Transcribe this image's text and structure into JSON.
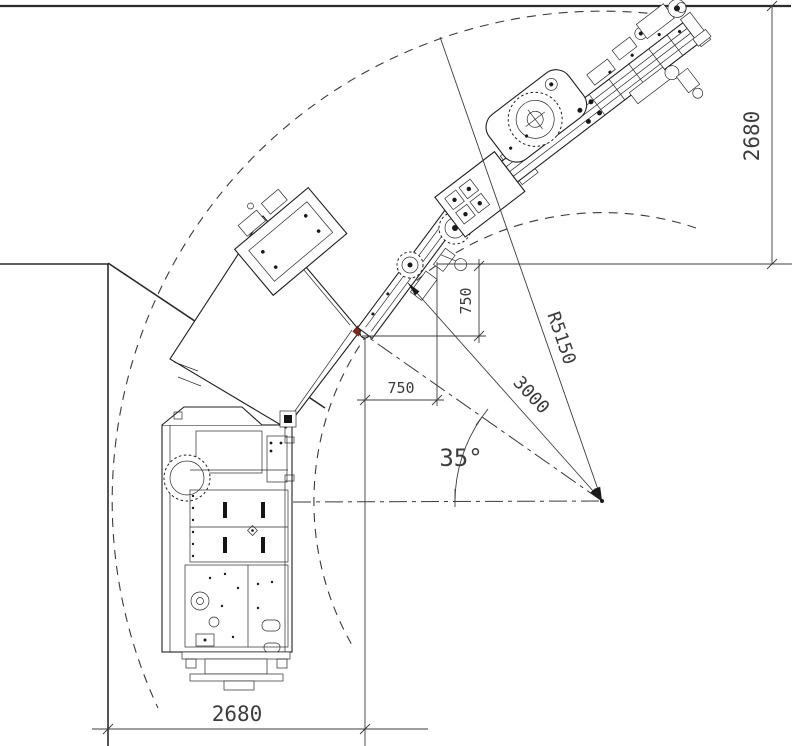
{
  "drawing": {
    "type": "underground-drill-rig-turning-clearance-plan",
    "dimensions": {
      "corridor_width_right": "2680",
      "corridor_width_bottom": "2680",
      "corner_offset_vertical": "750",
      "corner_offset_horizontal": "750",
      "outer_turning_radius": "R5150",
      "pivot_distance": "3000",
      "articulation_angle": "35°"
    },
    "colors": {
      "line": "#2b2b2b",
      "dim_text": "#3c3c3c",
      "background": "#ffffff",
      "hitch_accent": "#7a2a22"
    }
  }
}
